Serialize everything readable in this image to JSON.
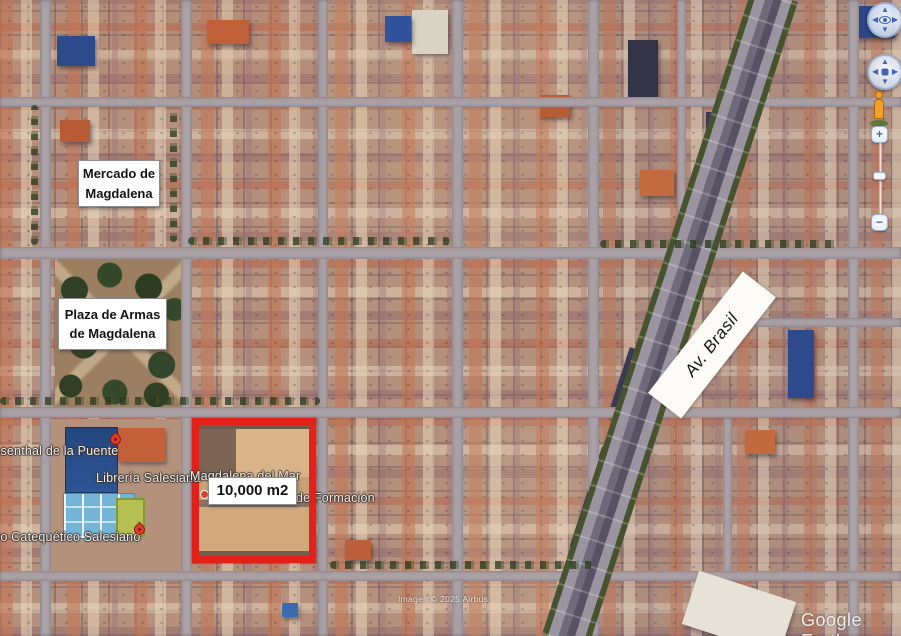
{
  "annotations": {
    "mercado": {
      "line1": "Mercado de",
      "line2": "Magdalena"
    },
    "plaza": {
      "line1": "Plaza de Armas",
      "line2": "de Magdalena"
    },
    "lot": {
      "area": "10,000 m2",
      "highlight_color": "#e3201a"
    },
    "avenue": {
      "name": "Av. Brasil"
    }
  },
  "place_labels": {
    "rosenthal": "ssenthal de la Puente",
    "libreria": "Librería Salesiana",
    "magdalena_del_mar": "Magdalena del Mar",
    "formacion": "de Formación",
    "catequetico": "ro Catequético Salesiano"
  },
  "attribution": {
    "imagery": "Imagen © 2025 Airbus",
    "watermark": "Google Earth"
  },
  "controls": {
    "zoom_in": "+",
    "zoom_out": "−",
    "icons": {
      "up": "▲",
      "down": "▼",
      "left": "◀",
      "right": "▶"
    }
  }
}
